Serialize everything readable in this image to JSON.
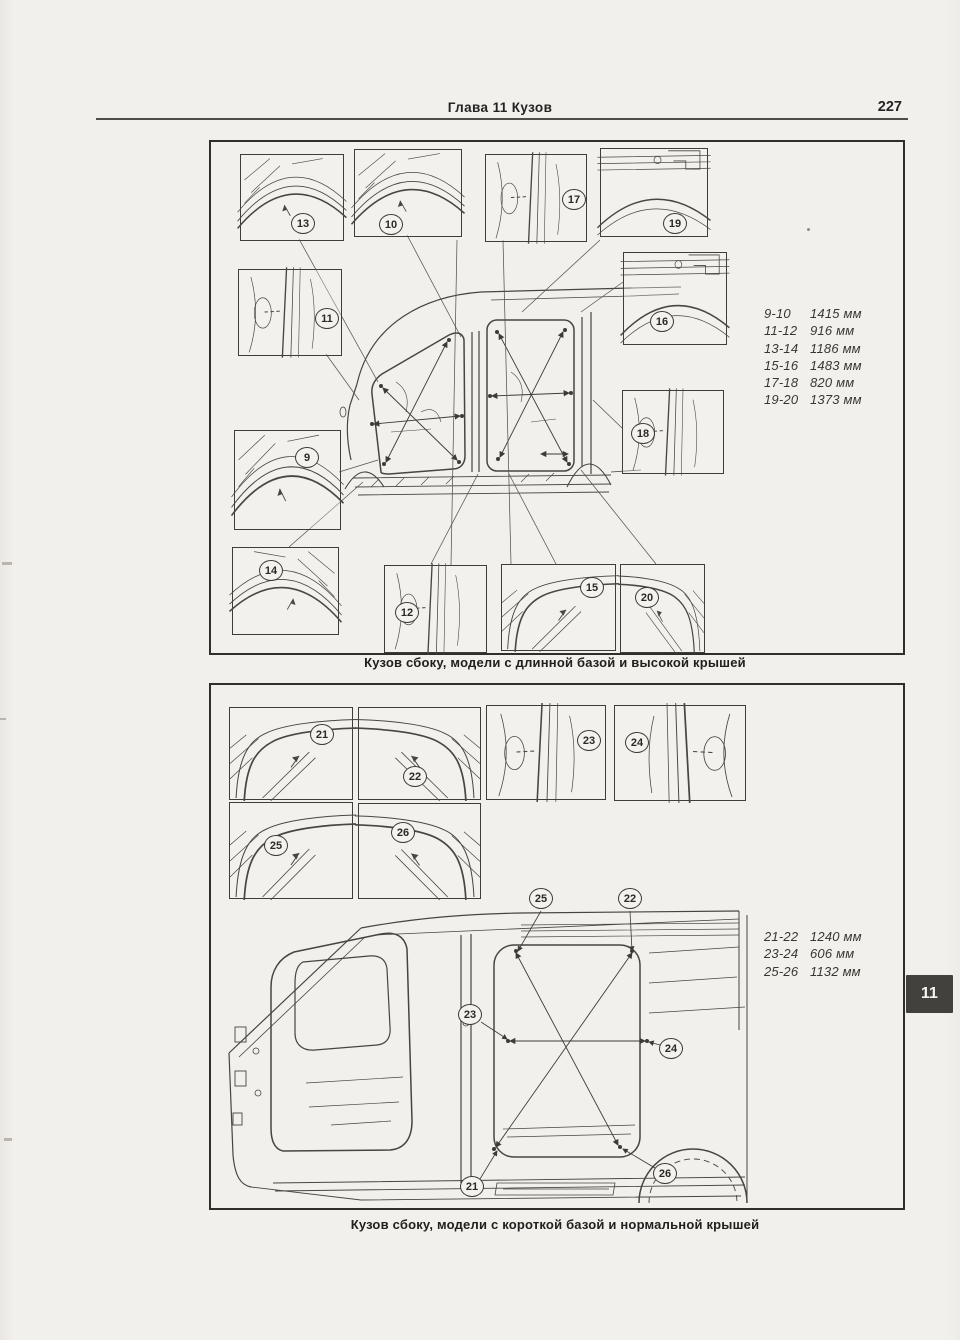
{
  "page": {
    "header_title": "Глава 11 Кузов",
    "page_number": "227",
    "chapter_tab": "11"
  },
  "figure1": {
    "caption": "Кузов сбоку, модели с длинной базой и высокой крышей",
    "measurements": [
      {
        "points": "9-10",
        "value": "1415 мм"
      },
      {
        "points": "11-12",
        "value": "916 мм"
      },
      {
        "points": "13-14",
        "value": "1186 мм"
      },
      {
        "points": "15-16",
        "value": "1483 мм"
      },
      {
        "points": "17-18",
        "value": "820 мм"
      },
      {
        "points": "19-20",
        "value": "1373 мм"
      }
    ],
    "insets": [
      {
        "num": "13"
      },
      {
        "num": "10"
      },
      {
        "num": "17"
      },
      {
        "num": "19"
      },
      {
        "num": "11"
      },
      {
        "num": "16"
      },
      {
        "num": "9"
      },
      {
        "num": "18"
      },
      {
        "num": "14"
      },
      {
        "num": "12"
      },
      {
        "num": "15"
      },
      {
        "num": "20"
      }
    ]
  },
  "figure2": {
    "caption": "Кузов сбоку, модели с короткой базой и нормальной крышей",
    "measurements": [
      {
        "points": "21-22",
        "value": "1240 мм"
      },
      {
        "points": "23-24",
        "value": "606 мм"
      },
      {
        "points": "25-26",
        "value": "1132 мм"
      }
    ],
    "insets": [
      {
        "num": "21"
      },
      {
        "num": "22"
      },
      {
        "num": "23"
      },
      {
        "num": "24"
      },
      {
        "num": "25"
      },
      {
        "num": "26"
      }
    ],
    "main_callouts": [
      {
        "num": "25"
      },
      {
        "num": "22"
      },
      {
        "num": "23"
      },
      {
        "num": "24"
      },
      {
        "num": "21"
      },
      {
        "num": "26"
      }
    ]
  }
}
